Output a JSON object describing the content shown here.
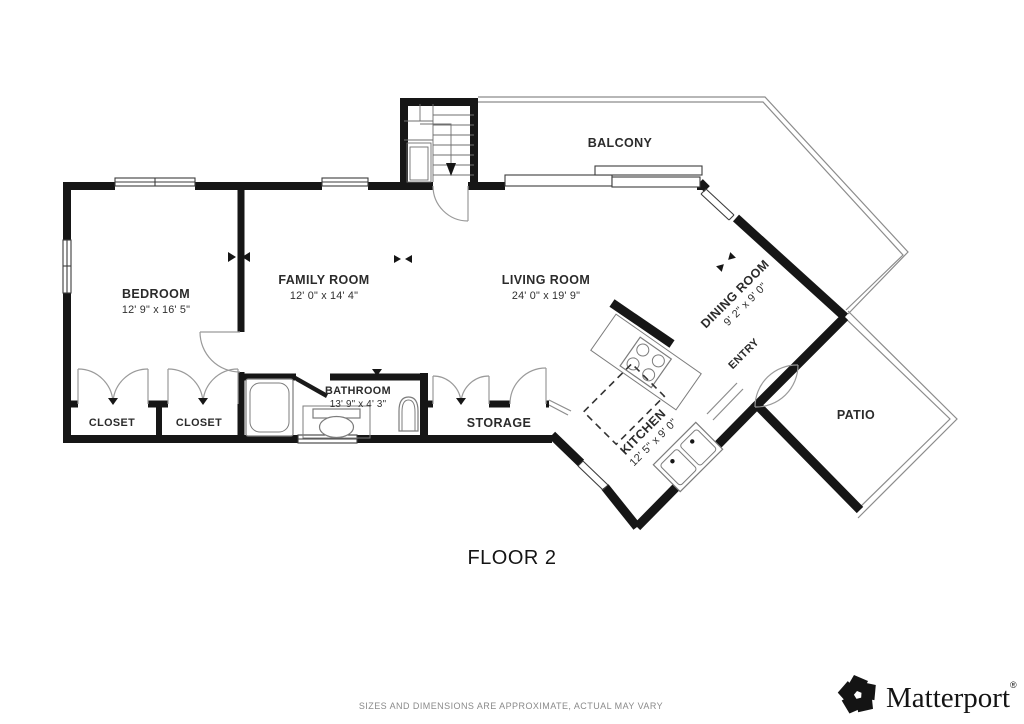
{
  "floor_label": "FLOOR 2",
  "footer": {
    "disclaimer": "SIZES AND DIMENSIONS ARE APPROXIMATE, ACTUAL MAY VARY"
  },
  "branding": {
    "name": "Matterport",
    "registered": "®"
  },
  "colors": {
    "wall": "#161616",
    "thin_outline": "#8c8c8c",
    "label_text": "#2b2b2b",
    "muted_text": "#8a8a8a",
    "background": "#ffffff"
  },
  "rooms": {
    "bedroom": {
      "name": "BEDROOM",
      "dims": "12' 9\" x 16' 5\""
    },
    "family_room": {
      "name": "FAMILY ROOM",
      "dims": "12' 0\" x 14' 4\""
    },
    "living_room": {
      "name": "LIVING ROOM",
      "dims": "24' 0\" x 19' 9\""
    },
    "dining_room": {
      "name": "DINING ROOM",
      "dims": "9' 2\" x 9' 0\""
    },
    "kitchen": {
      "name": "KITCHEN",
      "dims": "12' 5\" x 9' 0\""
    },
    "bathroom": {
      "name": "BATHROOM",
      "dims": "13' 9\" x 4' 3\""
    },
    "storage": {
      "name": "STORAGE"
    },
    "closet_left": {
      "name": "CLOSET"
    },
    "closet_right": {
      "name": "CLOSET"
    },
    "balcony": {
      "name": "BALCONY"
    },
    "entry": {
      "name": "ENTRY"
    },
    "patio": {
      "name": "PATIO"
    }
  }
}
